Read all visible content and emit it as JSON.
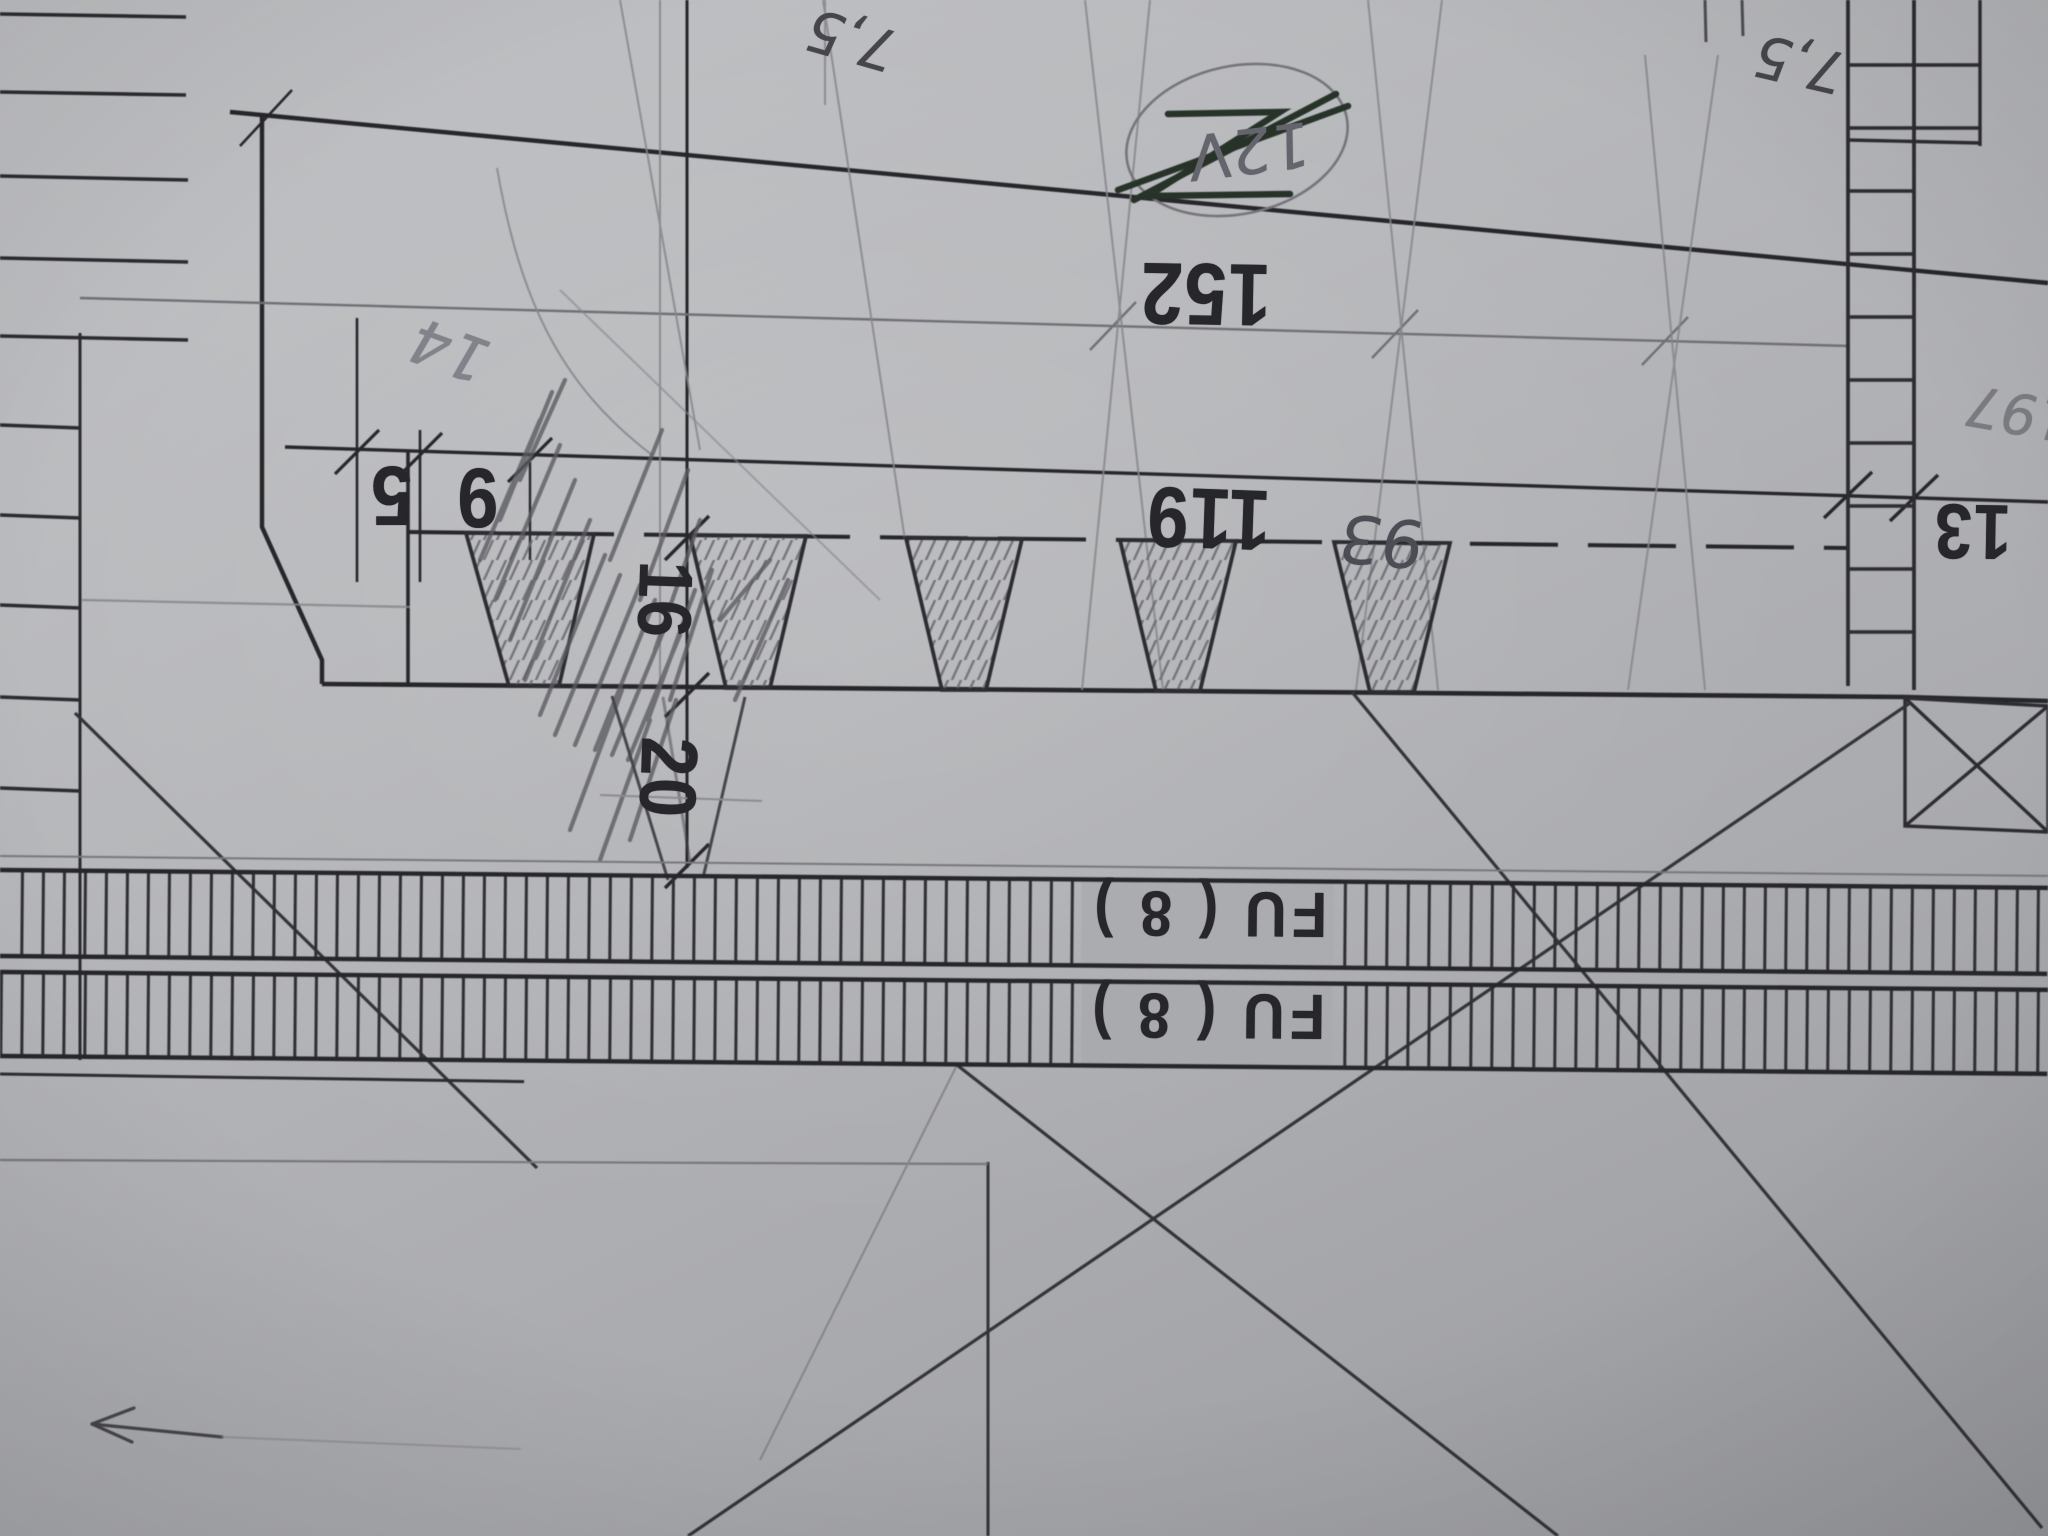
{
  "drawing": {
    "dims": {
      "d152": "152",
      "d119": "119",
      "d5": "5",
      "d9": "9",
      "d13": "13",
      "d16": "16",
      "d20": "20"
    },
    "handwritten": {
      "top_75": "7,5",
      "right_75": "7,5",
      "n14": "14",
      "n93": "93",
      "crossed_out": "12V",
      "right_197": "197"
    },
    "rails": {
      "fu8_top": "FU ( 8 )",
      "fu8_bottom": "FU ( 8 )"
    },
    "colors": {
      "paper": "#b4b5b8",
      "ink": "#26262b",
      "pencil": "#77777d",
      "scribble_ink": "#232d25"
    }
  }
}
